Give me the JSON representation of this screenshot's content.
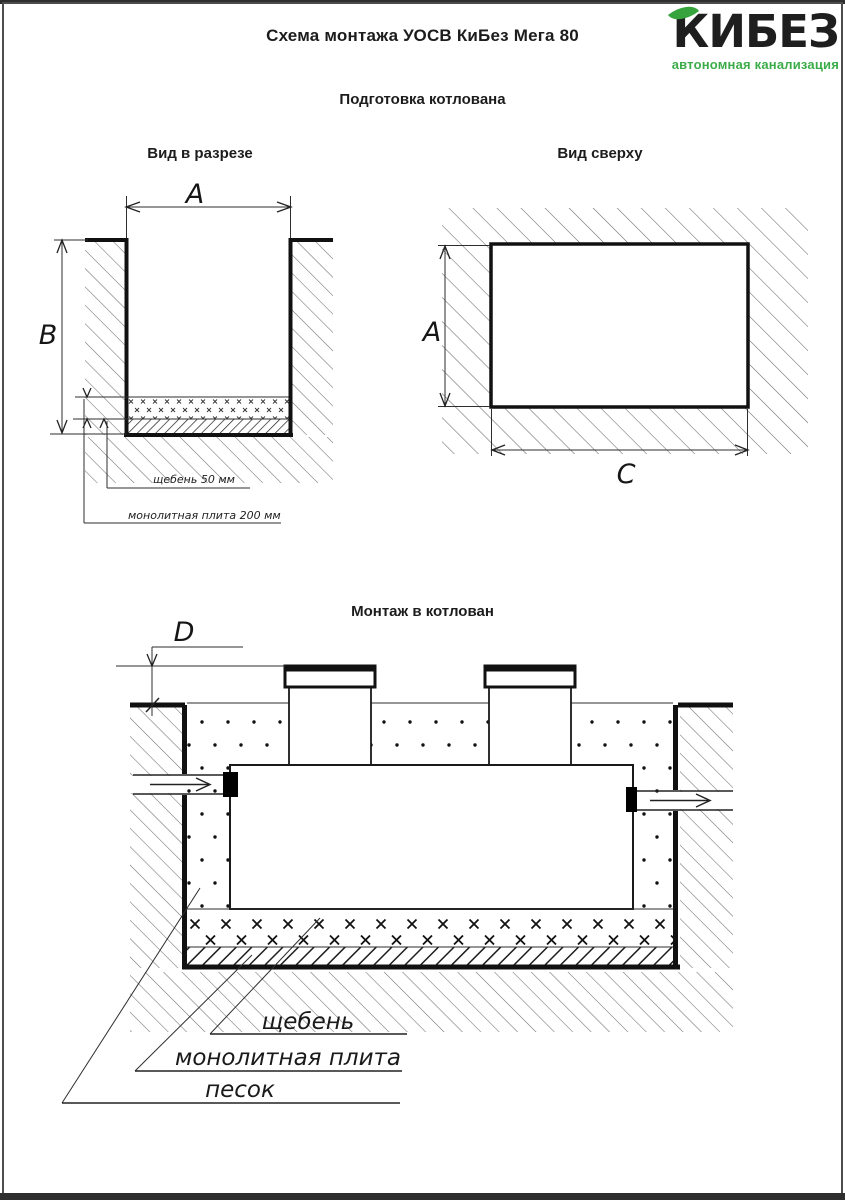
{
  "page": {
    "title": "Схема монтажа УОСВ КиБез Мега 80",
    "logo": {
      "brand": "КИБЕЗ",
      "tagline": "автономная канализация",
      "icon": "leaf-icon"
    },
    "colors": {
      "accent_green": "#3BAC49",
      "leaf_green": "#36A33D",
      "ink": "#1C1C1C",
      "hatch_gray": "#707070"
    }
  },
  "sections": {
    "pit_preparation": {
      "heading": "Подготовка котлована",
      "section_view": {
        "heading": "Вид в разрезе",
        "dim_width": "A",
        "dim_depth": "B",
        "note_gravel": "щебень 50 мм",
        "note_slab": "монолитная плита 200 мм"
      },
      "top_view": {
        "heading": "Вид сверху",
        "dim_width": "A",
        "dim_length": "C"
      }
    },
    "installation": {
      "heading": "Монтаж в котлован",
      "dim_cover": "D",
      "legend": {
        "gravel": "щебень",
        "slab": "монолитная плита",
        "sand": "песок"
      }
    }
  }
}
